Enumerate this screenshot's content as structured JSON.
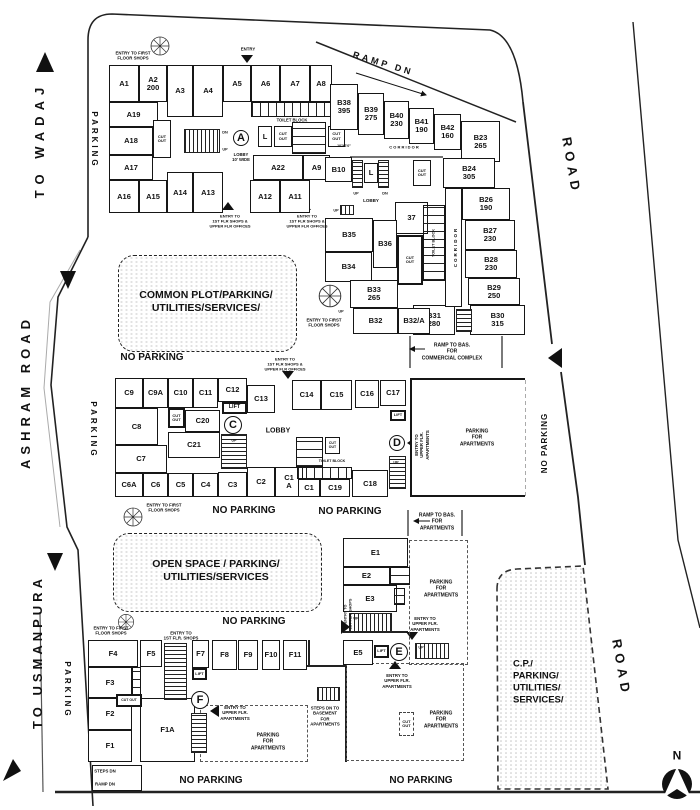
{
  "plan_title": "SITE / GROUND FLOOR PLAN",
  "zones": [
    {
      "name": "common-plot",
      "x": 118,
      "y": 255,
      "w": 177,
      "h": 95
    },
    {
      "name": "open-space",
      "x": 113,
      "y": 533,
      "w": 207,
      "h": 77
    }
  ],
  "rooms": [
    {
      "t": "A1",
      "x": 109,
      "y": 65,
      "w": 30,
      "h": 37
    },
    {
      "t": "A2\n200",
      "x": 139,
      "y": 65,
      "w": 28,
      "h": 37
    },
    {
      "t": "A3",
      "x": 167,
      "y": 65,
      "w": 26,
      "h": 52
    },
    {
      "t": "A4",
      "x": 193,
      "y": 65,
      "w": 30,
      "h": 52
    },
    {
      "t": "A5",
      "x": 223,
      "y": 65,
      "w": 28,
      "h": 37
    },
    {
      "t": "A6",
      "x": 251,
      "y": 65,
      "w": 29,
      "h": 37
    },
    {
      "t": "A7",
      "x": 280,
      "y": 65,
      "w": 30,
      "h": 37
    },
    {
      "t": "A8",
      "x": 310,
      "y": 65,
      "w": 22,
      "h": 37
    },
    {
      "t": "A19",
      "x": 109,
      "y": 102,
      "w": 49,
      "h": 25
    },
    {
      "t": "A18",
      "x": 109,
      "y": 127,
      "w": 44,
      "h": 28
    },
    {
      "t": "A17",
      "x": 109,
      "y": 155,
      "w": 44,
      "h": 25
    },
    {
      "t": "A16",
      "x": 109,
      "y": 180,
      "w": 30,
      "h": 33
    },
    {
      "t": "A15",
      "x": 139,
      "y": 180,
      "w": 28,
      "h": 33
    },
    {
      "t": "A14",
      "x": 167,
      "y": 172,
      "w": 26,
      "h": 41
    },
    {
      "t": "A13",
      "x": 193,
      "y": 172,
      "w": 30,
      "h": 41
    },
    {
      "t": "A22",
      "x": 253,
      "y": 155,
      "w": 50,
      "h": 25
    },
    {
      "t": "A9",
      "x": 303,
      "y": 155,
      "w": 27,
      "h": 25
    },
    {
      "t": "A12",
      "x": 250,
      "y": 180,
      "w": 30,
      "h": 33
    },
    {
      "t": "A11",
      "x": 280,
      "y": 180,
      "w": 30,
      "h": 33
    },
    {
      "t": "B10",
      "x": 325,
      "y": 157,
      "w": 27,
      "h": 25
    },
    {
      "t": "L",
      "x": 258,
      "y": 126,
      "w": 14,
      "h": 21
    },
    {
      "t": "CUT\nOUT",
      "x": 153,
      "y": 120,
      "w": 18,
      "h": 38,
      "fs": 4
    },
    {
      "t": "CUT\nOUT",
      "x": 274,
      "y": 126,
      "w": 18,
      "h": 21,
      "fs": 4
    },
    {
      "t": "CUT\nOUT",
      "x": 328,
      "y": 126,
      "w": 17,
      "h": 21,
      "fs": 4
    },
    {
      "t": "",
      "x": 251,
      "y": 102,
      "w": 86,
      "h": 15,
      "cls": "stalls-v"
    },
    {
      "t": "",
      "x": 292,
      "y": 122,
      "w": 34,
      "h": 32,
      "cls": "stalls-h"
    },
    {
      "t": "B38\n395",
      "x": 330,
      "y": 84,
      "w": 28,
      "h": 46
    },
    {
      "t": "B39\n275",
      "x": 358,
      "y": 93,
      "w": 26,
      "h": 42
    },
    {
      "t": "B40\n230",
      "x": 384,
      "y": 101,
      "w": 25,
      "h": 38
    },
    {
      "t": "B41\n190",
      "x": 409,
      "y": 108,
      "w": 25,
      "h": 36
    },
    {
      "t": "B42\n160",
      "x": 434,
      "y": 114,
      "w": 27,
      "h": 36
    },
    {
      "t": "B23\n265",
      "x": 461,
      "y": 121,
      "w": 39,
      "h": 41
    },
    {
      "t": "B24\n305",
      "x": 443,
      "y": 158,
      "w": 52,
      "h": 30
    },
    {
      "t": "CUT\nOUT",
      "x": 413,
      "y": 160,
      "w": 18,
      "h": 26,
      "fs": 4
    },
    {
      "t": "B26\n190",
      "x": 462,
      "y": 188,
      "w": 48,
      "h": 32
    },
    {
      "t": "B27\n230",
      "x": 465,
      "y": 220,
      "w": 50,
      "h": 30
    },
    {
      "t": "B28\n230",
      "x": 465,
      "y": 250,
      "w": 52,
      "h": 28
    },
    {
      "t": "B29\n250",
      "x": 468,
      "y": 278,
      "w": 52,
      "h": 27
    },
    {
      "t": "B30\n315",
      "x": 470,
      "y": 305,
      "w": 55,
      "h": 30
    },
    {
      "t": "B31\n280",
      "x": 413,
      "y": 305,
      "w": 42,
      "h": 30
    },
    {
      "t": "37",
      "x": 395,
      "y": 202,
      "w": 33,
      "h": 32
    },
    {
      "t": "CUT\nOUT",
      "x": 397,
      "y": 235,
      "w": 26,
      "h": 50,
      "fs": 4,
      "cls": "thick"
    },
    {
      "t": "B35",
      "x": 325,
      "y": 218,
      "w": 48,
      "h": 34
    },
    {
      "t": "B36",
      "x": 373,
      "y": 220,
      "w": 24,
      "h": 48
    },
    {
      "t": "B34",
      "x": 325,
      "y": 252,
      "w": 47,
      "h": 30
    },
    {
      "t": "B33\n265",
      "x": 350,
      "y": 280,
      "w": 48,
      "h": 28
    },
    {
      "t": "B32",
      "x": 353,
      "y": 308,
      "w": 45,
      "h": 26
    },
    {
      "t": "B32/A",
      "x": 398,
      "y": 308,
      "w": 32,
      "h": 26
    },
    {
      "t": "L",
      "x": 364,
      "y": 163,
      "w": 14,
      "h": 20
    },
    {
      "t": "",
      "x": 445,
      "y": 188,
      "w": 17,
      "h": 119
    },
    {
      "t": "",
      "x": 423,
      "y": 205,
      "w": 22,
      "h": 76,
      "cls": "stalls-h"
    },
    {
      "t": "C9",
      "x": 115,
      "y": 378,
      "w": 28,
      "h": 30
    },
    {
      "t": "C9A",
      "x": 143,
      "y": 378,
      "w": 25,
      "h": 30
    },
    {
      "t": "C10",
      "x": 168,
      "y": 378,
      "w": 25,
      "h": 30
    },
    {
      "t": "C11",
      "x": 193,
      "y": 378,
      "w": 25,
      "h": 30
    },
    {
      "t": "C12",
      "x": 218,
      "y": 378,
      "w": 29,
      "h": 24
    },
    {
      "t": "C13",
      "x": 247,
      "y": 385,
      "w": 28,
      "h": 28
    },
    {
      "t": "LIFT",
      "x": 222,
      "y": 402,
      "w": 25,
      "h": 12,
      "fs": 5.5,
      "cls": "thick"
    },
    {
      "t": "C8",
      "x": 115,
      "y": 408,
      "w": 43,
      "h": 37
    },
    {
      "t": "CUT\nOUT",
      "x": 168,
      "y": 408,
      "w": 17,
      "h": 20,
      "fs": 4,
      "cls": "thick"
    },
    {
      "t": "C20",
      "x": 185,
      "y": 410,
      "w": 35,
      "h": 22
    },
    {
      "t": "C21",
      "x": 168,
      "y": 432,
      "w": 52,
      "h": 26
    },
    {
      "t": "C7",
      "x": 115,
      "y": 445,
      "w": 52,
      "h": 28
    },
    {
      "t": "C6A",
      "x": 115,
      "y": 473,
      "w": 28,
      "h": 24
    },
    {
      "t": "C6",
      "x": 143,
      "y": 473,
      "w": 25,
      "h": 24
    },
    {
      "t": "C5",
      "x": 168,
      "y": 473,
      "w": 25,
      "h": 24
    },
    {
      "t": "C4",
      "x": 193,
      "y": 473,
      "w": 25,
      "h": 24
    },
    {
      "t": "C3",
      "x": 218,
      "y": 472,
      "w": 29,
      "h": 25
    },
    {
      "t": "C2",
      "x": 247,
      "y": 467,
      "w": 28,
      "h": 30
    },
    {
      "t": "C1\nA",
      "x": 275,
      "y": 467,
      "w": 28,
      "h": 30
    },
    {
      "t": "C14",
      "x": 292,
      "y": 380,
      "w": 29,
      "h": 30
    },
    {
      "t": "C15",
      "x": 321,
      "y": 380,
      "w": 31,
      "h": 30
    },
    {
      "t": "C16",
      "x": 355,
      "y": 380,
      "w": 24,
      "h": 28
    },
    {
      "t": "C17",
      "x": 380,
      "y": 380,
      "w": 26,
      "h": 26
    },
    {
      "t": "LIFT",
      "x": 390,
      "y": 410,
      "w": 16,
      "h": 11,
      "fs": 4,
      "cls": "thick"
    },
    {
      "t": "CUT\nOUT",
      "x": 325,
      "y": 437,
      "w": 15,
      "h": 17,
      "fs": 3.5
    },
    {
      "t": "",
      "x": 296,
      "y": 437,
      "w": 27,
      "h": 30,
      "cls": "stalls-h"
    },
    {
      "t": "",
      "x": 297,
      "y": 467,
      "w": 55,
      "h": 12,
      "cls": "stalls-v"
    },
    {
      "t": "C19",
      "x": 320,
      "y": 479,
      "w": 30,
      "h": 18
    },
    {
      "t": "C1",
      "x": 298,
      "y": 479,
      "w": 22,
      "h": 18
    },
    {
      "t": "C18",
      "x": 352,
      "y": 470,
      "w": 36,
      "h": 27
    },
    {
      "t": "E1",
      "x": 343,
      "y": 538,
      "w": 65,
      "h": 29
    },
    {
      "t": "E2",
      "x": 343,
      "y": 567,
      "w": 47,
      "h": 18
    },
    {
      "t": "E3",
      "x": 343,
      "y": 585,
      "w": 54,
      "h": 27
    },
    {
      "t": "E5",
      "x": 343,
      "y": 640,
      "w": 30,
      "h": 25
    },
    {
      "t": "LIFT",
      "x": 374,
      "y": 645,
      "w": 15,
      "h": 13,
      "fs": 4,
      "cls": "thick"
    },
    {
      "t": "",
      "x": 390,
      "y": 567,
      "w": 20,
      "h": 18,
      "cls": "stalls-h"
    },
    {
      "t": "",
      "x": 394,
      "y": 588,
      "w": 11,
      "h": 17,
      "cls": "stalls-h"
    },
    {
      "t": "F4",
      "x": 88,
      "y": 640,
      "w": 50,
      "h": 27
    },
    {
      "t": "F5",
      "x": 140,
      "y": 640,
      "w": 22,
      "h": 27
    },
    {
      "t": "F7",
      "x": 192,
      "y": 640,
      "w": 17,
      "h": 28
    },
    {
      "t": "F8",
      "x": 212,
      "y": 640,
      "w": 25,
      "h": 30
    },
    {
      "t": "F9",
      "x": 238,
      "y": 640,
      "w": 20,
      "h": 30
    },
    {
      "t": "F10",
      "x": 262,
      "y": 640,
      "w": 18,
      "h": 30
    },
    {
      "t": "F11",
      "x": 283,
      "y": 640,
      "w": 24,
      "h": 30
    },
    {
      "t": "F3",
      "x": 88,
      "y": 667,
      "w": 44,
      "h": 31
    },
    {
      "t": "F2",
      "x": 88,
      "y": 698,
      "w": 44,
      "h": 32
    },
    {
      "t": "F1",
      "x": 88,
      "y": 730,
      "w": 44,
      "h": 32
    },
    {
      "t": "F1A",
      "x": 140,
      "y": 698,
      "w": 55,
      "h": 64
    },
    {
      "t": "",
      "x": 132,
      "y": 667,
      "w": 9,
      "h": 30,
      "cls": "stalls-h"
    },
    {
      "t": "CUT OUT",
      "x": 116,
      "y": 694,
      "w": 26,
      "h": 13,
      "fs": 3.5,
      "cls": "thick"
    },
    {
      "t": "LIFT",
      "x": 192,
      "y": 668,
      "w": 15,
      "h": 12,
      "fs": 4,
      "cls": "thick"
    },
    {
      "t": "CUT\nOUT",
      "x": 399,
      "y": 712,
      "w": 15,
      "h": 24,
      "fs": 4,
      "cls": "dashedbox"
    },
    {
      "t": "",
      "x": 92,
      "y": 765,
      "w": 50,
      "h": 26
    }
  ],
  "wallboxes": [
    {
      "x": 410,
      "y": 378,
      "w": 115,
      "h": 119
    }
  ],
  "dashzones": [
    {
      "x": 409,
      "y": 540,
      "w": 59,
      "h": 125
    },
    {
      "x": 200,
      "y": 705,
      "w": 108,
      "h": 57
    },
    {
      "x": 346,
      "y": 663,
      "w": 118,
      "h": 98
    }
  ],
  "stairs": [
    {
      "x": 184,
      "y": 129,
      "w": 36,
      "h": 24,
      "d": "h"
    },
    {
      "x": 352,
      "y": 160,
      "w": 11,
      "h": 28,
      "d": "v"
    },
    {
      "x": 378,
      "y": 160,
      "w": 11,
      "h": 28,
      "d": "v"
    },
    {
      "x": 340,
      "y": 205,
      "w": 14,
      "h": 10,
      "d": "h"
    },
    {
      "x": 456,
      "y": 309,
      "w": 16,
      "h": 23,
      "d": "v"
    },
    {
      "x": 221,
      "y": 434,
      "w": 26,
      "h": 35,
      "d": "v"
    },
    {
      "x": 389,
      "y": 456,
      "w": 17,
      "h": 33,
      "d": "v"
    },
    {
      "x": 349,
      "y": 613,
      "w": 43,
      "h": 19,
      "d": "h"
    },
    {
      "x": 415,
      "y": 643,
      "w": 34,
      "h": 16,
      "d": "h"
    },
    {
      "x": 164,
      "y": 643,
      "w": 23,
      "h": 57,
      "d": "v"
    },
    {
      "x": 191,
      "y": 713,
      "w": 16,
      "h": 40,
      "d": "v"
    },
    {
      "x": 317,
      "y": 687,
      "w": 23,
      "h": 14,
      "d": "h"
    }
  ],
  "circles": [
    {
      "t": "A",
      "x": 241,
      "y": 138,
      "r": 8
    },
    {
      "t": "C",
      "x": 233,
      "y": 425,
      "r": 9
    },
    {
      "t": "D",
      "x": 397,
      "y": 443,
      "r": 8
    },
    {
      "t": "E",
      "x": 399,
      "y": 652,
      "r": 9
    },
    {
      "t": "F",
      "x": 200,
      "y": 700,
      "r": 9
    }
  ],
  "labels": [
    {
      "t": "TO WADAJ",
      "x": 40,
      "y": 140,
      "fs": 13,
      "rot": -90,
      "ls": 6
    },
    {
      "t": "ASHRAM ROAD",
      "x": 26,
      "y": 392,
      "fs": 13,
      "rot": -90,
      "ls": 5
    },
    {
      "t": "TO USMANPURA",
      "x": 38,
      "y": 652,
      "fs": 13,
      "rot": -90,
      "ls": 4
    },
    {
      "t": "ROAD",
      "x": 571,
      "y": 166,
      "fs": 13,
      "rot": 80,
      "ls": 5
    },
    {
      "t": "ROAD",
      "x": 621,
      "y": 668,
      "fs": 13,
      "rot": 80,
      "ls": 5
    },
    {
      "t": "PARKING",
      "x": 94,
      "y": 140,
      "fs": 8,
      "rot": 90,
      "ls": 3
    },
    {
      "t": "PARKING",
      "x": 93,
      "y": 430,
      "fs": 8,
      "rot": 90,
      "ls": 3
    },
    {
      "t": "PARKING",
      "x": 67,
      "y": 690,
      "fs": 8,
      "rot": 90,
      "ls": 3
    },
    {
      "t": "NO PARKING",
      "x": 545,
      "y": 443,
      "fs": 8,
      "rot": -90,
      "ls": 1
    },
    {
      "t": "N",
      "x": 677,
      "y": 756,
      "fs": 12,
      "b": 1
    },
    {
      "t": "NO PARKING",
      "x": 152,
      "y": 358,
      "fs": 10,
      "b": 1
    },
    {
      "t": "NO PARKING",
      "x": 244,
      "y": 511,
      "fs": 10,
      "b": 1
    },
    {
      "t": "NO PARKING",
      "x": 350,
      "y": 512,
      "fs": 10,
      "b": 1
    },
    {
      "t": "NO PARKING",
      "x": 254,
      "y": 622,
      "fs": 10,
      "b": 1
    },
    {
      "t": "NO PARKING",
      "x": 211,
      "y": 781,
      "fs": 10,
      "b": 1
    },
    {
      "t": "NO PARKING",
      "x": 421,
      "y": 781,
      "fs": 10,
      "b": 1
    },
    {
      "t": "COMMON PLOT/PARKING/\nUTILITIES/SERVICES/",
      "x": 206,
      "y": 302,
      "fs": 10.5,
      "b": 1
    },
    {
      "t": "OPEN SPACE / PARKING/\nUTILITIES/SERVICES",
      "x": 216,
      "y": 571,
      "fs": 10.5,
      "b": 1
    },
    {
      "t": "C.P./\nPARKING/\nUTILITIES/\nSERVICES/",
      "x": 513,
      "y": 682,
      "fs": 9.5,
      "left": 1
    },
    {
      "t": "ENTRY TO FIRST\nFLOOR SHOPS",
      "x": 133,
      "y": 56,
      "fs": 4.3
    },
    {
      "t": "ENTRY",
      "x": 248,
      "y": 49,
      "fs": 4.3
    },
    {
      "t": "RAMP DN",
      "x": 383,
      "y": 64,
      "fs": 9,
      "rot": 17,
      "ls": 3
    },
    {
      "t": "TOILET BLOCK",
      "x": 292,
      "y": 120,
      "fs": 4.2
    },
    {
      "t": "LOBBY\n10' WIDE",
      "x": 241,
      "y": 157,
      "fs": 4.2
    },
    {
      "t": "DN",
      "x": 225,
      "y": 133,
      "fs": 3.8
    },
    {
      "t": "UP",
      "x": 225,
      "y": 150,
      "fs": 3.8
    },
    {
      "t": "ENTRY TO\n1ST FLR SHOPS &\nUPPER FLR OFFICES",
      "x": 230,
      "y": 221,
      "fs": 4
    },
    {
      "t": "ENTRY TO\n1ST FLR SHOPS &\nUPPER FLR OFFICES",
      "x": 307,
      "y": 221,
      "fs": 4
    },
    {
      "t": "10'X6'0\"",
      "x": 344,
      "y": 146,
      "fs": 3.6
    },
    {
      "t": "C O R R I D O R",
      "x": 404,
      "y": 147,
      "fs": 4
    },
    {
      "t": "UP",
      "x": 356,
      "y": 194,
      "fs": 3.8
    },
    {
      "t": "DN",
      "x": 385,
      "y": 194,
      "fs": 3.8
    },
    {
      "t": "LOBBY",
      "x": 371,
      "y": 201,
      "fs": 4.5
    },
    {
      "t": "UP",
      "x": 336,
      "y": 211,
      "fs": 3.8
    },
    {
      "t": "CORRIDOR",
      "x": 456,
      "y": 247,
      "fs": 4.5,
      "rot": -90,
      "ls": 2
    },
    {
      "t": "TOILET BLOCK",
      "x": 434,
      "y": 243,
      "fs": 3.8,
      "rot": -90
    },
    {
      "t": "UP",
      "x": 341,
      "y": 312,
      "fs": 3.8
    },
    {
      "t": "ENTRY TO FIRST\nFLOOR SHOPS",
      "x": 324,
      "y": 323,
      "fs": 4.3
    },
    {
      "t": "RAMP TO BAS.\nFOR\nCOMMERCIAL COMPLEX",
      "x": 452,
      "y": 352,
      "fs": 5
    },
    {
      "t": "ENTRY TO\n1ST FLR SHOPS &\nUPPER FLR OFFICES",
      "x": 285,
      "y": 364,
      "fs": 4
    },
    {
      "t": "LOBBY",
      "x": 278,
      "y": 432,
      "fs": 7
    },
    {
      "t": "UP",
      "x": 234,
      "y": 441,
      "fs": 3.8
    },
    {
      "t": "TOILET BLOCK",
      "x": 332,
      "y": 461,
      "fs": 3.6
    },
    {
      "t": "ENTRY TO\nUPPER FLR.\nAPARTMENTS",
      "x": 422,
      "y": 445,
      "fs": 4.3,
      "rot": -90
    },
    {
      "t": "PARKING\nFOR\nAPARTMENTS",
      "x": 477,
      "y": 438,
      "fs": 5
    },
    {
      "t": "UP",
      "x": 396,
      "y": 463,
      "fs": 3.8
    },
    {
      "t": "ENTRY TO FIRST\nFLOOR SHOPS",
      "x": 164,
      "y": 508,
      "fs": 4.3
    },
    {
      "t": "RAMP TO BAS.\nFOR\nAPARTMENTS",
      "x": 437,
      "y": 522,
      "fs": 5
    },
    {
      "t": "PARKING\nFOR\nAPARTMENTS",
      "x": 441,
      "y": 589,
      "fs": 5
    },
    {
      "t": "ENTRY TO\n1ST FLR. SHOPS",
      "x": 348,
      "y": 614,
      "fs": 3.8,
      "rot": -90
    },
    {
      "t": "UP",
      "x": 356,
      "y": 619,
      "fs": 3.8
    },
    {
      "t": "ENTRY TO\nUPPER FLR.\nAPARTMENTS",
      "x": 425,
      "y": 624,
      "fs": 4.3
    },
    {
      "t": "UP",
      "x": 421,
      "y": 648,
      "fs": 3.8
    },
    {
      "t": "ENTRY TO\nUPPER FLR.\nAPARTMENTS",
      "x": 397,
      "y": 681,
      "fs": 4.3
    },
    {
      "t": "ENTRY TO FIRST\nFLOOR SHOPS",
      "x": 111,
      "y": 631,
      "fs": 4.3
    },
    {
      "t": "ENTRY TO\n1ST FLR. SHOPS",
      "x": 181,
      "y": 636,
      "fs": 4.3
    },
    {
      "t": "ENTRY TO\nUPPER FLR.\nAPARTMENTS",
      "x": 235,
      "y": 713,
      "fs": 4.3
    },
    {
      "t": "PARKING\nFOR\nAPARTMENTS",
      "x": 268,
      "y": 742,
      "fs": 5
    },
    {
      "t": "STEPS DN TO\nBASEMENT\nFOR\nAPARTMENTS",
      "x": 325,
      "y": 716,
      "fs": 4.3
    },
    {
      "t": "PARKING\nFOR\nAPARTMENTS",
      "x": 441,
      "y": 720,
      "fs": 5
    },
    {
      "t": "STEPS DN",
      "x": 105,
      "y": 771,
      "fs": 4.3
    },
    {
      "t": "RAMP DN",
      "x": 105,
      "y": 784,
      "fs": 4.3
    }
  ]
}
